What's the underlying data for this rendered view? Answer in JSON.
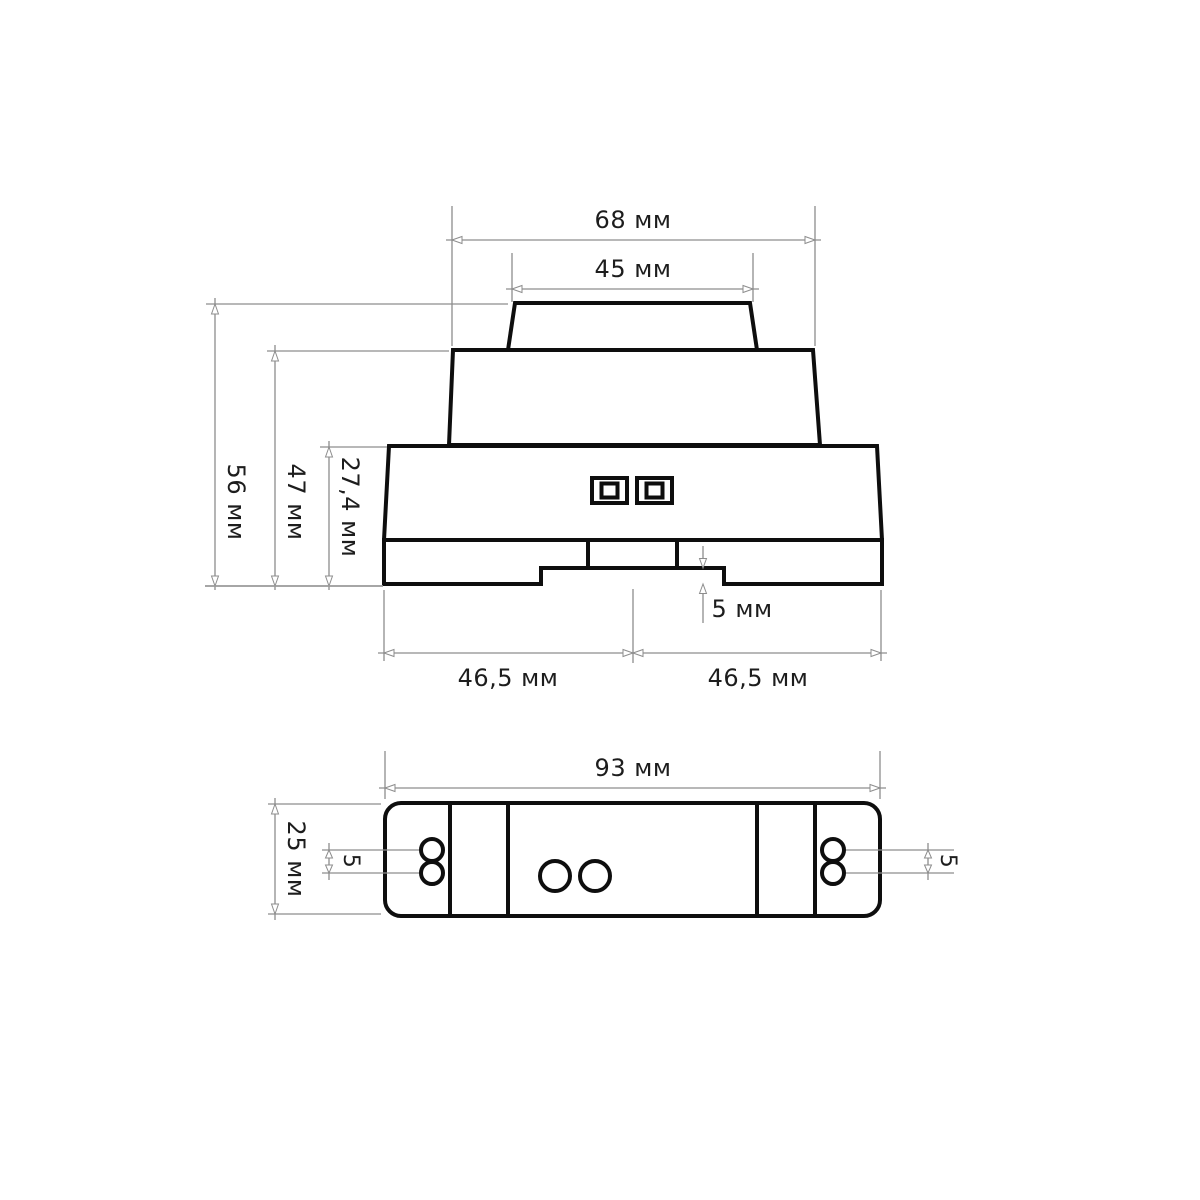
{
  "canvas": {
    "background_color": "#ffffff",
    "outline_color": "#0e0e0e",
    "dimension_line_color": "#8d8d8d",
    "label_color": "#1d1d1d",
    "units": "мм"
  },
  "drawing": {
    "front_view": {
      "overall_width": "68 мм",
      "cap_width": "45 мм",
      "total_height": "56 мм",
      "upper_height": "47 мм",
      "base_height": "27,4 мм",
      "rail_step_depth": "5 мм",
      "base_half_left": "46,5 мм",
      "base_half_right": "46,5 мм"
    },
    "bottom_view": {
      "overall_length": "93 мм",
      "overall_width": "25 мм",
      "terminal_pitch_left": "5",
      "terminal_pitch_right": "5"
    }
  }
}
